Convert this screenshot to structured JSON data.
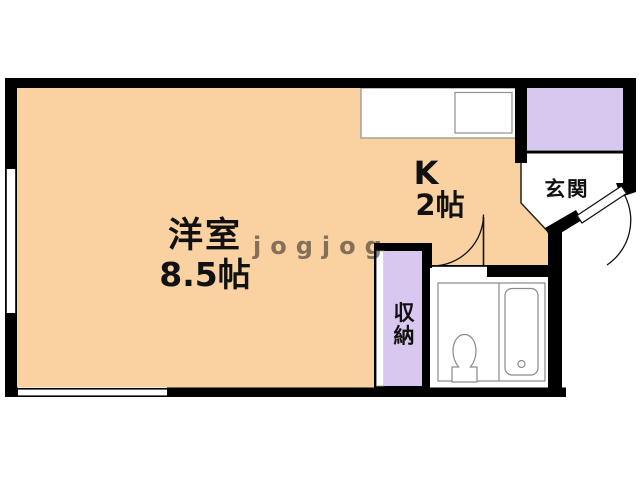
{
  "floorplan": {
    "rooms": {
      "living": {
        "name": "洋室",
        "size": "8.5帖"
      },
      "kitchen": {
        "name": "K",
        "size": "2帖"
      },
      "entrance": {
        "name": "玄関"
      },
      "storage": {
        "name": "収納",
        "char1": "収",
        "char2": "納"
      }
    },
    "watermark": "jogjog",
    "icons": {
      "toilet": "toilet-plan-symbol",
      "bathtub": "bathtub-plan-symbol",
      "kitchen_counter": "counter-with-sink-symbol",
      "door_arcs": "door-swing-arc-symbol",
      "windows": "double-line-window-symbol"
    }
  },
  "colors": {
    "floor_orange": "#FAD2A2",
    "closet_purple": "#D8C7EF",
    "wall_black": "#000000",
    "fixture_gray": "#8A8A8A",
    "watermark_white": "#FFFFFF",
    "background": "#FFFFFF"
  }
}
